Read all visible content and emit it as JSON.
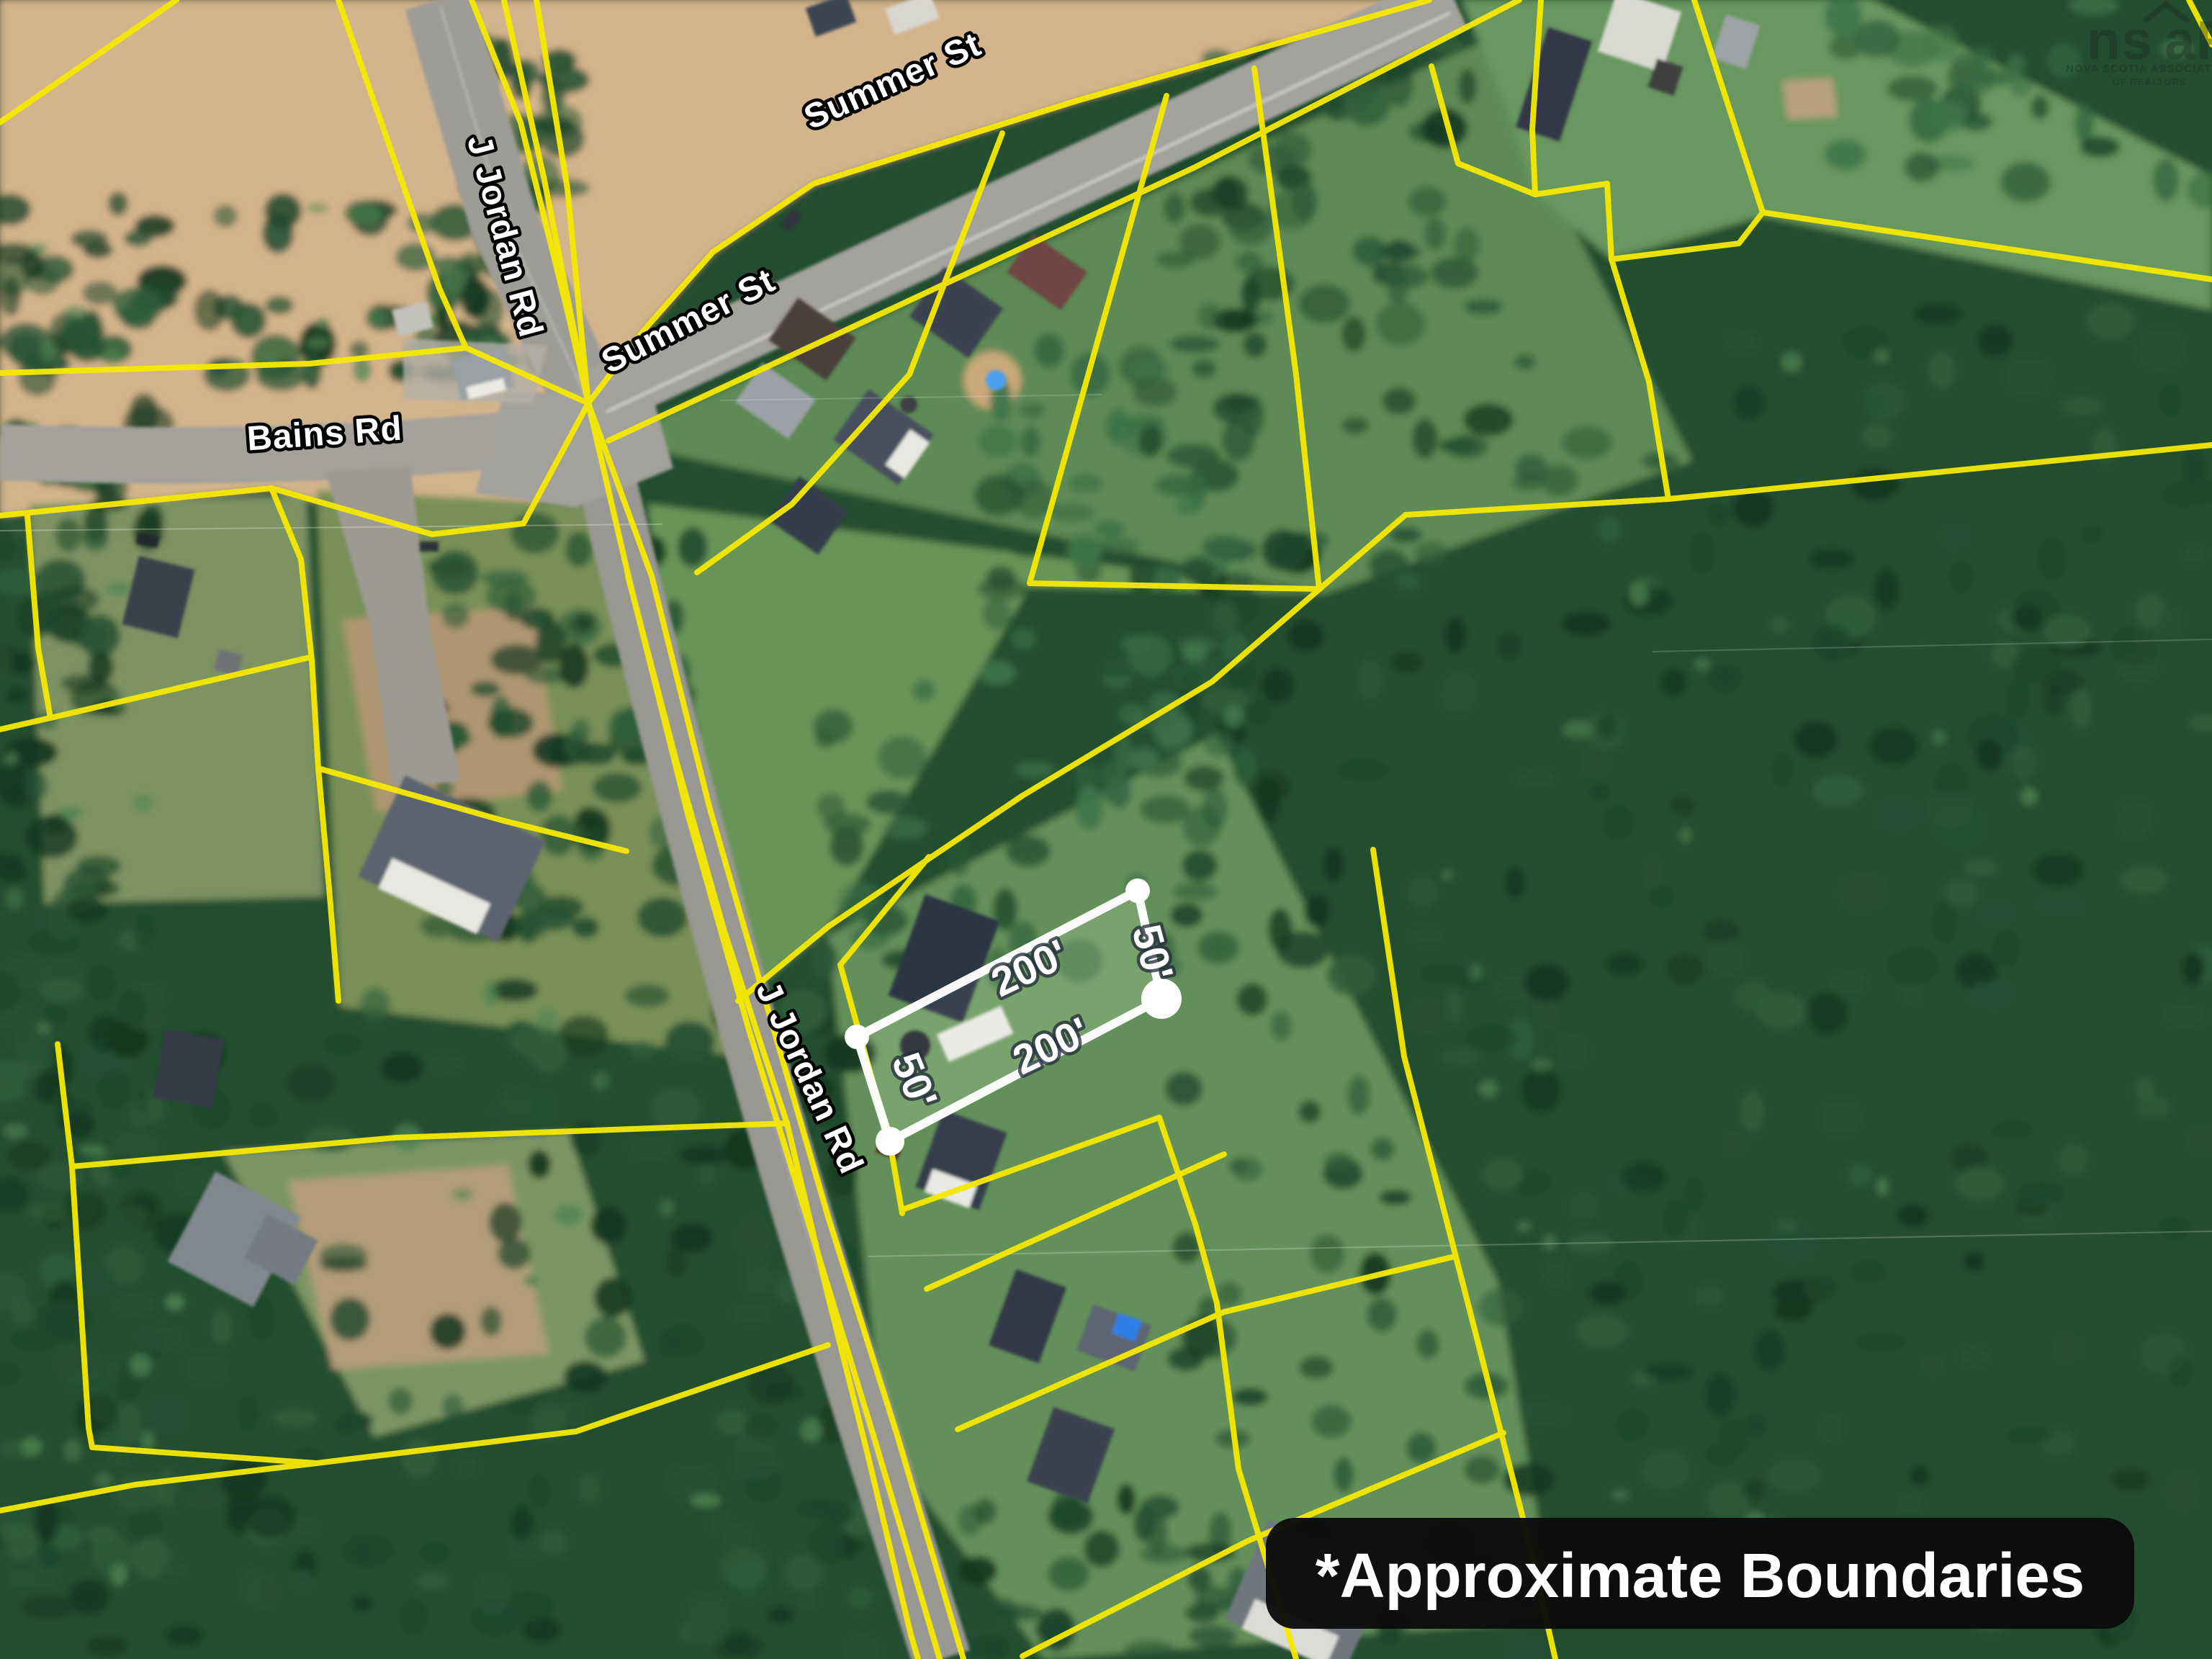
{
  "map": {
    "streets": {
      "j_jordan_north": "J Jordan Rd",
      "summer_upper": "Summer St",
      "summer_lower": "Summer St",
      "bains": "Bains Rd",
      "j_jordan_south": "J Jordan Rd",
      "j_jordan_partial": "J"
    },
    "highlight": {
      "front_length": "200'",
      "back_length": "200'",
      "right_width": "50'",
      "left_width": "50'"
    },
    "note": {
      "text": "*Approximate Boundaries"
    },
    "watermark": {
      "logo_left": "ns",
      "logo_right": "aR",
      "caption_line1": "NOVA SCOTIA ASSOCIATION",
      "caption_line2": "OF REALTORS"
    },
    "colors": {
      "boundary_yellow": "#f6e900",
      "highlight_white": "#ffffff",
      "field_tan": "#d4b48c",
      "forest_green": "#234e2f",
      "road_gray": "#9d9c96",
      "note_bg": "#0b0b0b",
      "note_text": "#ffffff",
      "label_text": "#ffffff"
    }
  }
}
